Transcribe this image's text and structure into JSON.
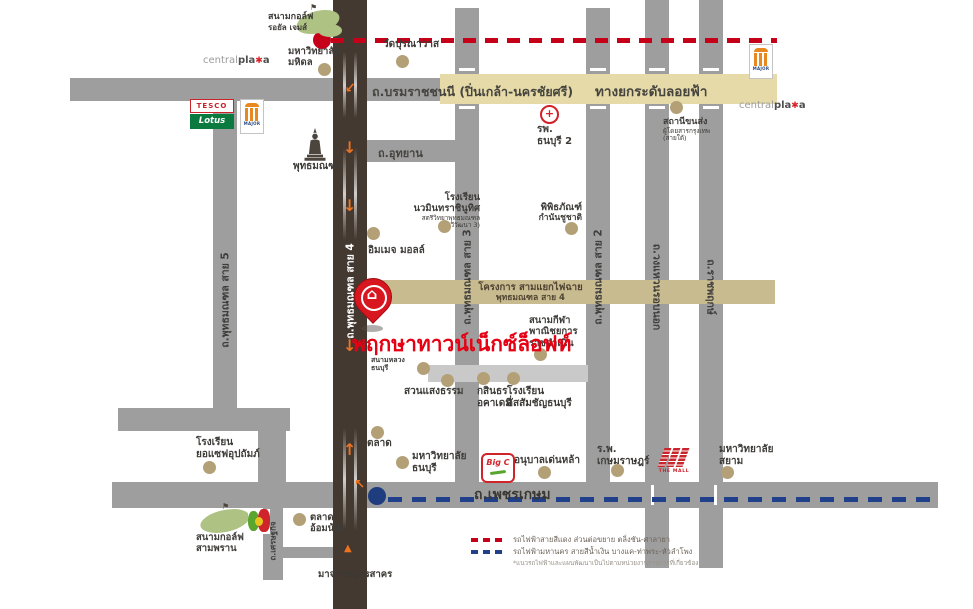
{
  "project": {
    "name": "พฤกษาทาวน์เน็กซ์ล็อฟท์"
  },
  "roads": {
    "borommaratchachonnani": "ถ.บรมราชชนนี (ปิ่นเกล้า-นครชัยศรี)",
    "skyway": "ทางยกระดับลอยฟ้า",
    "utthayan": "ถ.อุทยาน",
    "phutthamonthon_sai5": "ถ.พุทธมณฑล สาย 5",
    "phutthamonthon_sai4": "ถ.พุทธมณฑล สาย 4",
    "phutthamonthon_sai3": "ถ.พุทธมณฑล สาย 3",
    "phutthamonthon_sai2": "ถ.พุทธมณฑล สาย 2",
    "ring_road": "ถ.วงแหวนรอบนอก",
    "ratchaphruek": "ถ.ราชพฤกษ์",
    "setthakit": "ถ.เศรษฐกิจ",
    "phetkasem": "ถ.เพชรเกษม",
    "from_samut_sakhon": "มาจากสมุทรสาคร"
  },
  "transit_project": {
    "line1": "โครงการ สามแยกไฟฉาย",
    "line2": "พุทธมณฑล สาย 4"
  },
  "landmarks": {
    "royal_gems_golf": {
      "line1": "สนามกอล์ฟ",
      "line2": "รอยัล เจมส์"
    },
    "mahidol_university": {
      "line1": "มหาวิทยาลัย",
      "line2": "มหิดล"
    },
    "wat_puranawat": {
      "line1": "วัดปุรณาวาส"
    },
    "thonburi2_hospital": {
      "line1": "รพ.",
      "line2": "ธนบุรี 2"
    },
    "southern_bus_terminal": {
      "line1": "สถานีขนส่ง",
      "line2": "ผู้โดยสารกรุงเทพ",
      "line3": "(สายใต้)"
    },
    "phutthamonthon_park": {
      "line1": "พุทธมณฑล"
    },
    "nawamin_school": {
      "line1": "โรงเรียน",
      "line2": "นวมินทราชินูทิศ",
      "line3": "สตรีวิทยาพุทธมณฑล",
      "line4": "(ทวีวัฒนา 3)"
    },
    "image_mall": {
      "line1": "อิมเมจ มอลล์"
    },
    "kamnan_museum": {
      "line1": "พิพิธภัณฑ์",
      "line2": "กำนันชูชาติ"
    },
    "ratchadamnoen_stadium": {
      "line1": "สนามกีฬา",
      "line2": "พาณิชยการ",
      "line3": "ราชดำเนิน"
    },
    "sanam_luang_thonburi": {
      "line1": "สนามหลวง",
      "line2": "ธนบุรี"
    },
    "suan_saeng_tham": {
      "line1": "สวนแสงธรรม"
    },
    "kasintorn_academy": {
      "line1": "กสินธร",
      "line2": "อคาเดมี่"
    },
    "assumption_thonburi": {
      "line1": "โรงเรียน",
      "line2": "อัสสัมชัญธนบุรี"
    },
    "yosef_school": {
      "line1": "โรงเรียน",
      "line2": "ยอแซฟอุปถัมภ์"
    },
    "market": {
      "line1": "ตลาด"
    },
    "thonburi_university": {
      "line1": "มหาวิทยาลัย",
      "line2": "ธนบุรี"
    },
    "denla_kindergarten": {
      "line1": "อนุบาลเด่นหล้า"
    },
    "kasemrad_hospital": {
      "line1": "ร.พ.",
      "line2": "เกษมราษฎร์"
    },
    "siam_university": {
      "line1": "มหาวิทยาลัย",
      "line2": "สยาม"
    },
    "om_noi_market": {
      "line1": "ตลาด",
      "line2": "อ้อมน้อย"
    },
    "sampran_golf": {
      "line1": "สนามกอล์ฟ",
      "line2": "สามพราน"
    }
  },
  "logos": {
    "central": {
      "p1": "central",
      "p2": "pla",
      "p3": "a"
    },
    "tesco": {
      "line1": "TESCO",
      "line2": "Lotus"
    },
    "major": "MAJOR",
    "bigc": "Big C",
    "the_mall": "THE MALL"
  },
  "legend": {
    "red_label": "รถไฟฟ้าสายสีแดง ส่วนต่อขยาย ตลิ่งชัน-ศาลายา",
    "blue_label": "รถไฟฟ้ามหานคร สายสีน้ำเงิน บางแค-ท่าพระ-หัวลำโพง",
    "note": "*แนวรถไฟฟ้าและแผนพัฒนาเป็นไปตามหน่วยงานราชการที่เกี่ยวข้อง"
  },
  "icons": {
    "down_arrow": "↓",
    "up_arrow": "↑",
    "triangle_up": "▲",
    "house": "⌂",
    "star": "✱",
    "flag": "⚑",
    "cross": "+"
  },
  "colors": {
    "road_gray": "#9e9e9e",
    "road_minor": "#c9c9c9",
    "road_dark": "#443931",
    "band_skyway": "#e5daa8",
    "band_project": "#c9bb90",
    "landmark_dot": "#b3a077",
    "pin_red": "#d8161f",
    "project_text_red": "#e60013",
    "rail_red": "#c50018",
    "rail_blue": "#20408c",
    "arrow_orange": "#ee7320",
    "golf_green": "#aec284"
  }
}
